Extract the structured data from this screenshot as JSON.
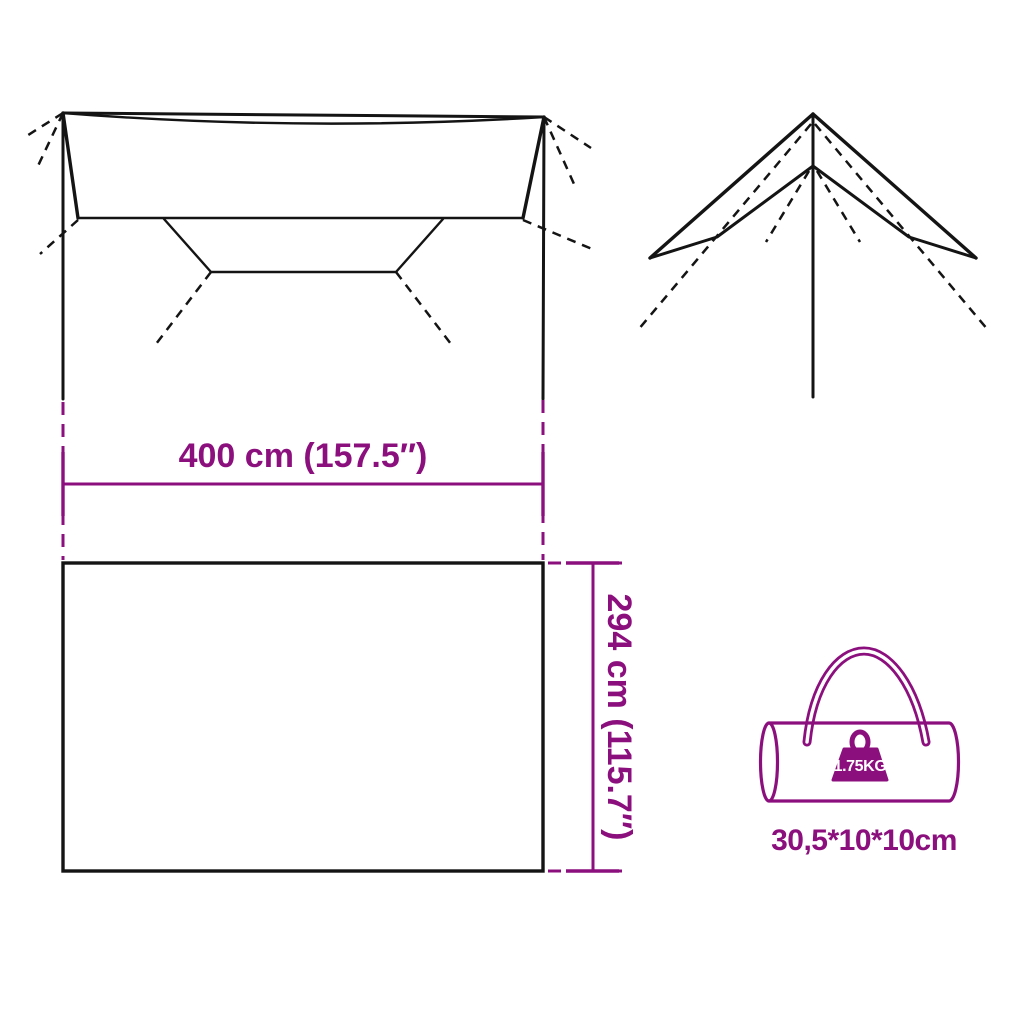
{
  "title": "Tarp product dimensions diagram",
  "colors": {
    "accent": "#8c0f7e",
    "line_color": "#141414",
    "background": "#ffffff",
    "weight_text": "#ffffff"
  },
  "dimensions": {
    "width": {
      "label": "400 cm (157.5″)"
    },
    "height": {
      "label": "294 cm (115.7″)"
    }
  },
  "bag": {
    "weight_label": "1.75KG",
    "packed_size_label": "30,5*10*10cm"
  },
  "icons": {
    "weight_badge": "weight-icon",
    "carry_bag": "duffel-bag-icon",
    "tarp_top": "tarp-top-view-drawing",
    "tarp_side": "tarp-side-view-drawing"
  }
}
